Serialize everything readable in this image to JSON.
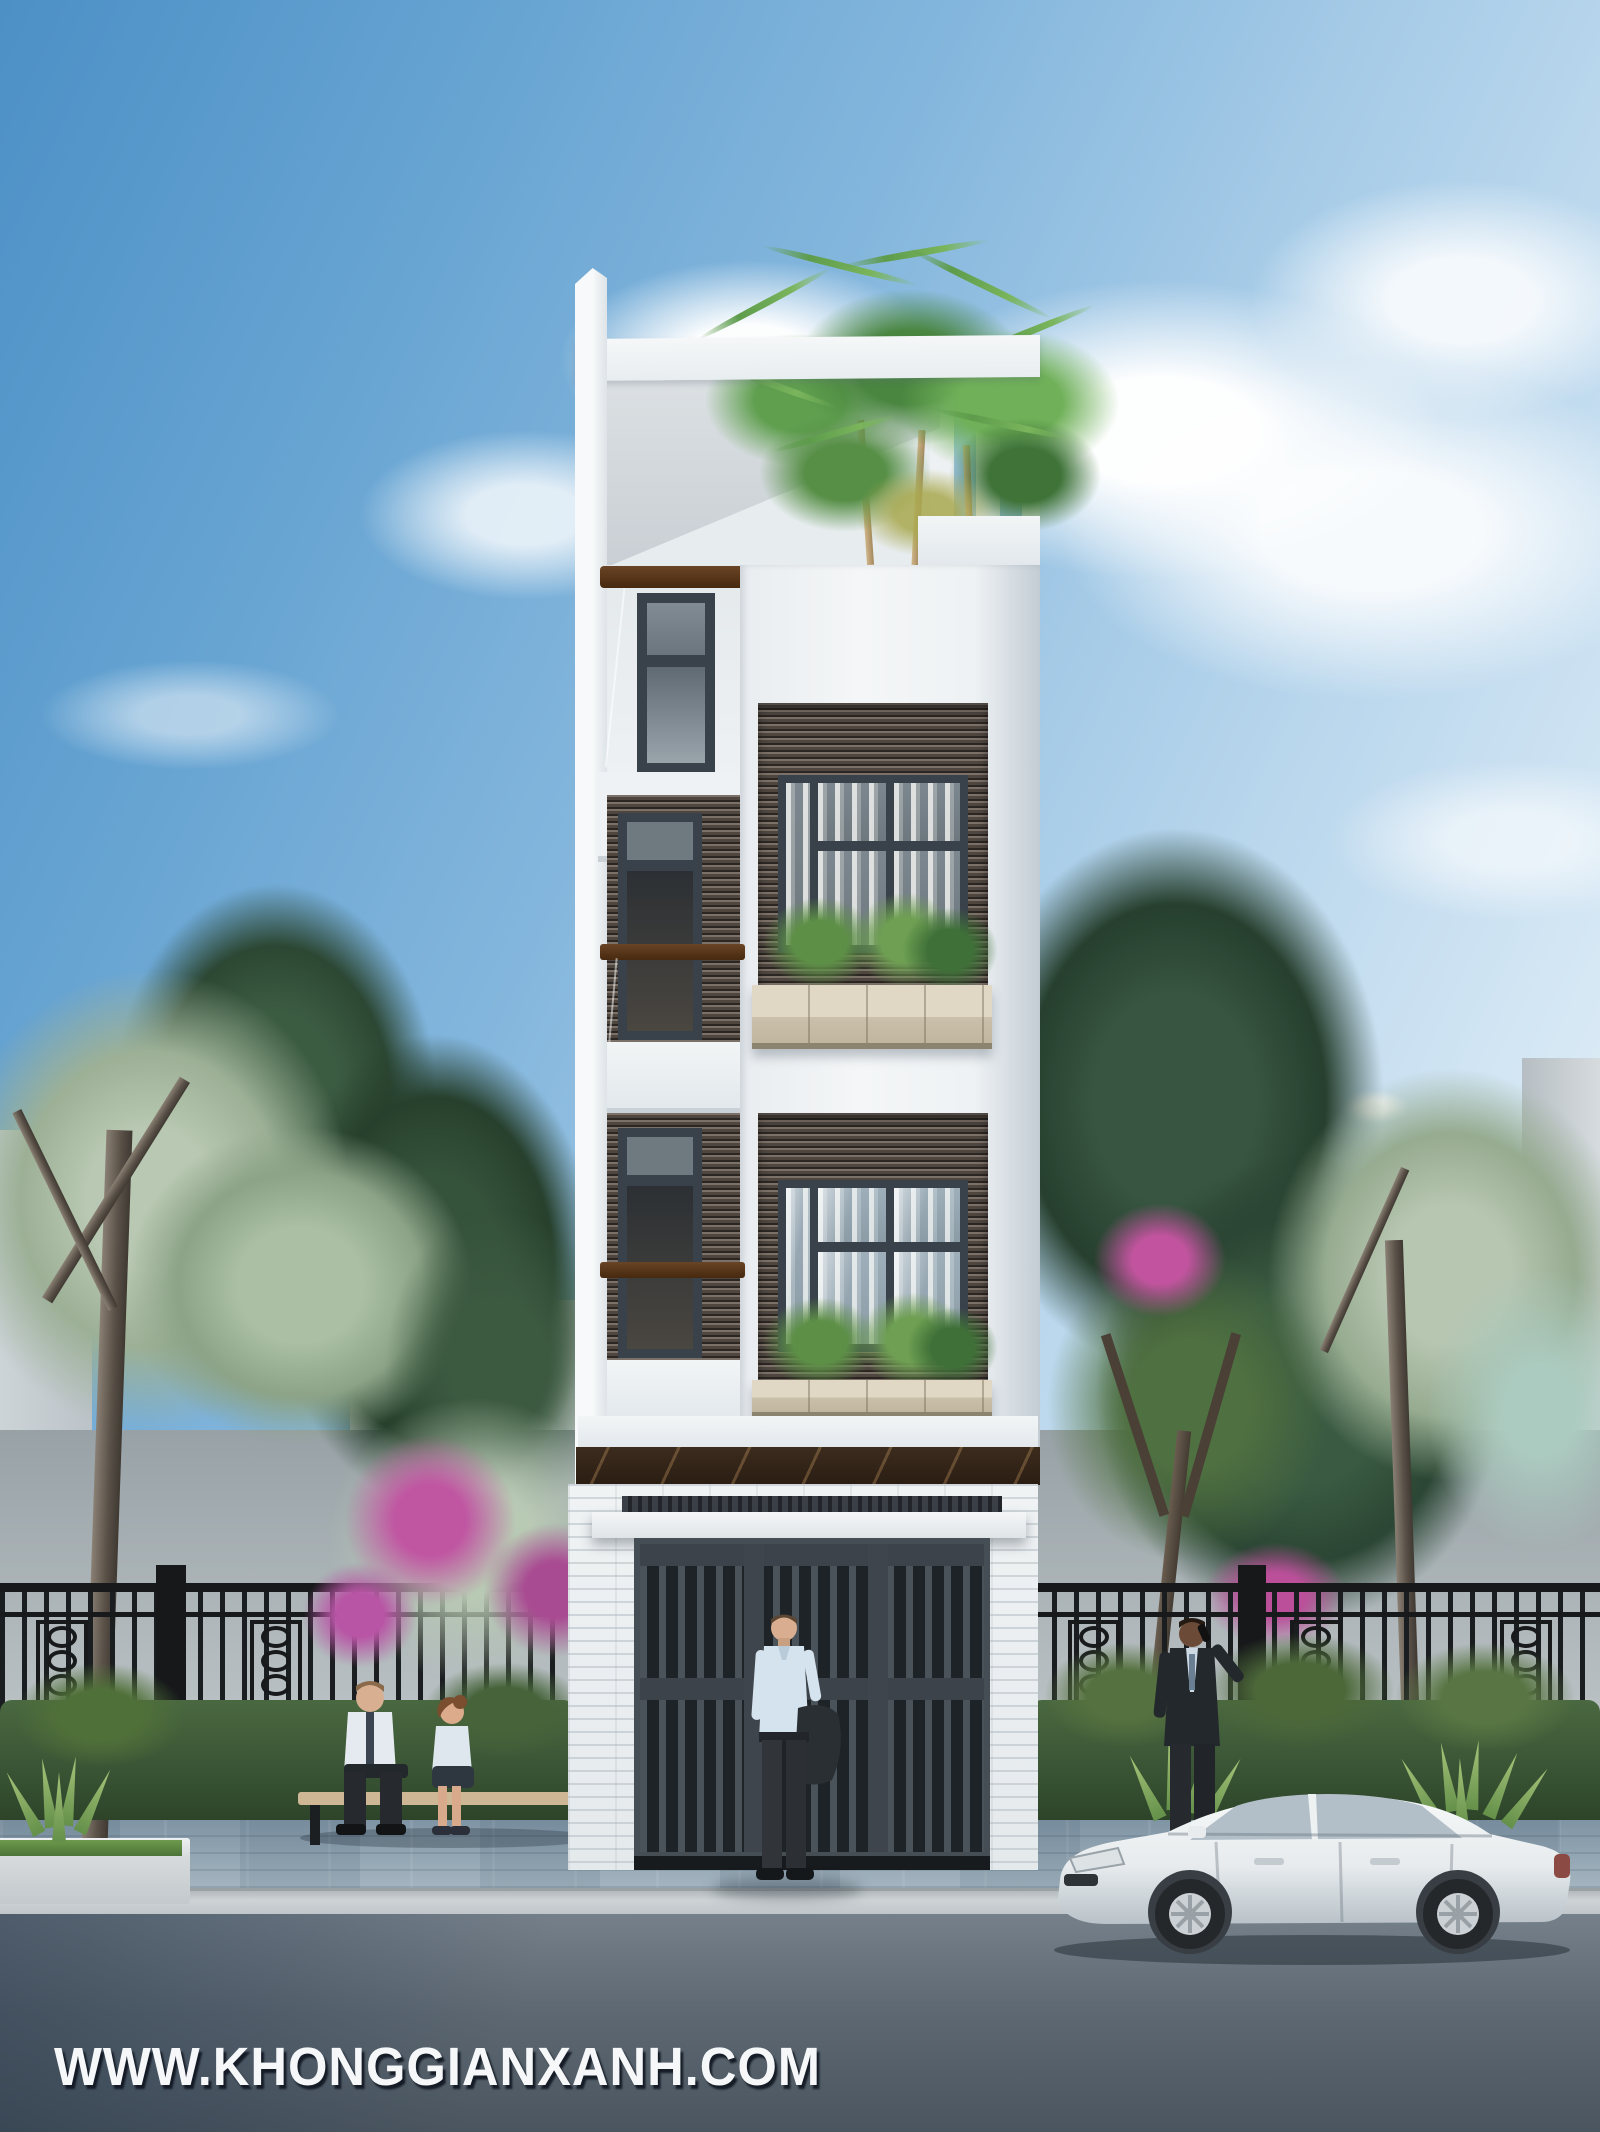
{
  "watermark": {
    "text": "WWW.KHONGGIANXANH.COM"
  },
  "scene": {
    "description": "Photorealistic exterior render of a narrow four-storey modern townhouse street elevation with rooftop palm terrace, two bay-window floors with stone plant boxes, slatted entry gate, ornamental iron fence, street trees, three pedestrians, a seated couple on a bench and a parked white sedan",
    "sky": {
      "top_color": "#4c90c6",
      "horizon_color": "#f3f9fc",
      "cloud_color": "#ffffff"
    },
    "building": {
      "facade_color": "#f3f5f7",
      "window_frame_color": "#39424a",
      "wood_rail_color": "#5b3a20",
      "slat_cladding_color": "#4e463f",
      "planter_stone_color": "#d6ccb8",
      "marble_band_color": "#33261b",
      "gate_color": "#3c434a",
      "ground_wall": "white stacked-stone texture"
    },
    "street": {
      "sidewalk_color": "#8ba0af",
      "curb_color": "#c6cbcd",
      "road_color": "#55606b"
    },
    "vegetation": {
      "dark_tree_color": "#34503a",
      "sage_tree_color": "#aebfa7",
      "bougainvillea_color": "#c056a2",
      "hedge_color": "#3f5b39",
      "palm_color": "#5e9c4c"
    },
    "figures": [
      "man holding jacket standing at gate",
      "businessman on phone beside car",
      "man and woman seated on bench"
    ],
    "vehicle": {
      "type": "white sedan",
      "body_color": "#e9edef"
    }
  }
}
